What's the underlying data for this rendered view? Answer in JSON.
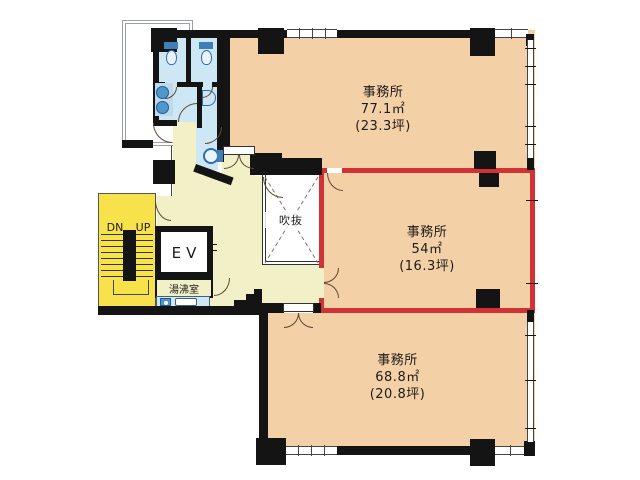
{
  "rooms": {
    "office_top": {
      "name": "事務所",
      "area_m2": "77.1㎡",
      "area_tsubo": "(23.3坪)"
    },
    "office_middle": {
      "name": "事務所",
      "area_m2": "54㎡",
      "area_tsubo": "(16.3坪)"
    },
    "office_bottom": {
      "name": "事務所",
      "area_m2": "68.8㎡",
      "area_tsubo": "(20.8坪)"
    },
    "elevator": {
      "label": "EV"
    },
    "kitchenette": {
      "label": "湯沸室"
    },
    "atrium": {
      "label": "吹抜"
    },
    "stairs": {
      "down": "DN",
      "up": "UP"
    }
  },
  "highlight": {
    "room": "office_middle",
    "color": "#d03236"
  },
  "colors": {
    "room_fill": "#f3d0a5",
    "corridor_fill": "#f1f0c6",
    "stairs_fill": "#f7e24b",
    "wet_area_fill": "#cde7f5",
    "wall": "#141414",
    "highlight_red": "#d03236"
  }
}
